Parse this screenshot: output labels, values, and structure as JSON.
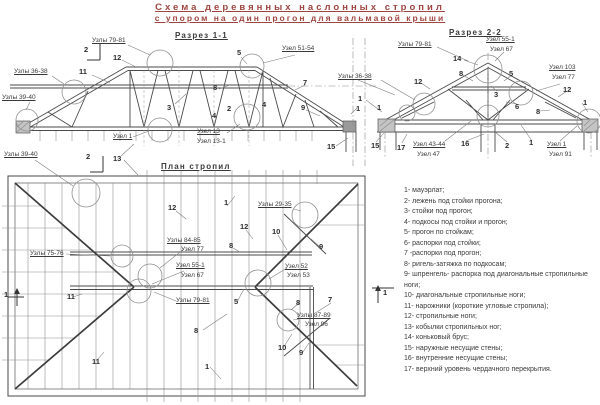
{
  "colors": {
    "title": "#a04540",
    "line": "#4a4a4a",
    "circle": "#909090"
  },
  "title": {
    "line1": "Схема деревянных наслонных стропил",
    "line2": "с упором на один прогон для вальмавой крыши"
  },
  "section1": {
    "title": "Разрез 1-1",
    "labels": [
      {
        "text": "Узлы 79-81",
        "x": 92,
        "y": 37,
        "u": 1
      },
      {
        "text": "2",
        "x": 84,
        "y": 46,
        "b": 1
      },
      {
        "text": "12",
        "x": 113,
        "y": 54,
        "b": 1
      },
      {
        "text": "11",
        "x": 79,
        "y": 68,
        "b": 1
      },
      {
        "text": "Узлы 36-38",
        "x": 14,
        "y": 68,
        "u": 1
      },
      {
        "text": "Узлы 39-40",
        "x": 2,
        "y": 94,
        "u": 1
      },
      {
        "text": "5",
        "x": 237,
        "y": 49,
        "b": 1
      },
      {
        "text": "Узел 51-54",
        "x": 282,
        "y": 45,
        "u": 1
      },
      {
        "text": "8",
        "x": 213,
        "y": 84,
        "b": 1
      },
      {
        "text": "3",
        "x": 167,
        "y": 104,
        "b": 1
      },
      {
        "text": "7",
        "x": 303,
        "y": 79,
        "b": 1
      },
      {
        "text": "2",
        "x": 227,
        "y": 105,
        "b": 1
      },
      {
        "text": "4",
        "x": 212,
        "y": 112,
        "b": 1
      },
      {
        "text": "4",
        "x": 262,
        "y": 101,
        "b": 1
      },
      {
        "text": "9",
        "x": 301,
        "y": 104,
        "b": 1
      },
      {
        "text": "1",
        "x": 356,
        "y": 105,
        "b": 1
      },
      {
        "text": "Узел 13",
        "x": 197,
        "y": 128,
        "u": 1
      },
      {
        "text": "Узел 13-1",
        "x": 197,
        "y": 138
      },
      {
        "text": "Узел 1",
        "x": 113,
        "y": 133,
        "u": 1
      },
      {
        "text": "15",
        "x": 327,
        "y": 143,
        "b": 1
      },
      {
        "text": "2",
        "x": 86,
        "y": 153,
        "b": 1
      }
    ]
  },
  "section2": {
    "title": "Разрез 2-2",
    "labels": [
      {
        "text": "Узлы 79-81",
        "x": 398,
        "y": 41,
        "u": 1
      },
      {
        "text": "14",
        "x": 453,
        "y": 55,
        "b": 1
      },
      {
        "text": "Узел 55-1",
        "x": 486,
        "y": 36,
        "u": 1
      },
      {
        "text": "Узел 67",
        "x": 490,
        "y": 46
      },
      {
        "text": "Узел 103",
        "x": 549,
        "y": 64,
        "u": 1
      },
      {
        "text": "Узел 77",
        "x": 552,
        "y": 74
      },
      {
        "text": "Узлы 36-38",
        "x": 338,
        "y": 73,
        "u": 1
      },
      {
        "text": "8",
        "x": 459,
        "y": 70,
        "b": 1
      },
      {
        "text": "5",
        "x": 509,
        "y": 70,
        "b": 1
      },
      {
        "text": "3",
        "x": 494,
        "y": 91,
        "b": 1
      },
      {
        "text": "12",
        "x": 414,
        "y": 78,
        "b": 1
      },
      {
        "text": "12",
        "x": 563,
        "y": 86,
        "b": 1
      },
      {
        "text": "6",
        "x": 515,
        "y": 103,
        "b": 1
      },
      {
        "text": "8",
        "x": 536,
        "y": 108,
        "b": 1
      },
      {
        "text": "1",
        "x": 358,
        "y": 95,
        "b": 1
      },
      {
        "text": "1",
        "x": 377,
        "y": 104,
        "b": 1
      },
      {
        "text": "1",
        "x": 583,
        "y": 99,
        "b": 1
      },
      {
        "text": "15",
        "x": 371,
        "y": 142,
        "b": 1
      },
      {
        "text": "17",
        "x": 397,
        "y": 144,
        "b": 1
      },
      {
        "text": "Узел 43-44",
        "x": 413,
        "y": 141,
        "u": 1
      },
      {
        "text": "Узел 47",
        "x": 417,
        "y": 151
      },
      {
        "text": "16",
        "x": 461,
        "y": 140,
        "b": 1
      },
      {
        "text": "2",
        "x": 505,
        "y": 142,
        "b": 1
      },
      {
        "text": "1",
        "x": 529,
        "y": 139,
        "b": 1
      },
      {
        "text": "Узел 1",
        "x": 547,
        "y": 141,
        "u": 1
      },
      {
        "text": "Узел 91",
        "x": 549,
        "y": 151
      }
    ]
  },
  "plan": {
    "title": "План стропил",
    "labels": [
      {
        "text": "Узлы 39-40",
        "x": 4,
        "y": 151,
        "u": 1
      },
      {
        "text": "13",
        "x": 113,
        "y": 155,
        "b": 1
      },
      {
        "text": "12",
        "x": 168,
        "y": 204,
        "b": 1
      },
      {
        "text": "1",
        "x": 224,
        "y": 199,
        "b": 1
      },
      {
        "text": "Узлы 29-35",
        "x": 258,
        "y": 201,
        "u": 1
      },
      {
        "text": "12",
        "x": 240,
        "y": 223,
        "b": 1
      },
      {
        "text": "10",
        "x": 272,
        "y": 228,
        "b": 1
      },
      {
        "text": "9",
        "x": 319,
        "y": 243,
        "b": 1
      },
      {
        "text": "Узлы 84-85",
        "x": 167,
        "y": 237,
        "u": 1
      },
      {
        "text": "Узел 77",
        "x": 181,
        "y": 246
      },
      {
        "text": "8",
        "x": 229,
        "y": 242,
        "b": 1
      },
      {
        "text": "Узел 55-1",
        "x": 176,
        "y": 262,
        "u": 1
      },
      {
        "text": "Узел 67",
        "x": 181,
        "y": 272
      },
      {
        "text": "Узлы 75-76",
        "x": 30,
        "y": 250,
        "u": 1
      },
      {
        "text": "Узлы 79-81",
        "x": 176,
        "y": 297,
        "u": 1
      },
      {
        "text": "5",
        "x": 234,
        "y": 298,
        "b": 1
      },
      {
        "text": "Узел 52",
        "x": 285,
        "y": 263,
        "u": 1
      },
      {
        "text": "Узел 53",
        "x": 287,
        "y": 272
      },
      {
        "text": "7",
        "x": 328,
        "y": 296,
        "b": 1
      },
      {
        "text": "8",
        "x": 296,
        "y": 299,
        "b": 1
      },
      {
        "text": "Узлы 87-89",
        "x": 297,
        "y": 312,
        "u": 1
      },
      {
        "text": "Узел 96",
        "x": 305,
        "y": 321
      },
      {
        "text": "8",
        "x": 194,
        "y": 327,
        "b": 1
      },
      {
        "text": "10",
        "x": 278,
        "y": 344,
        "b": 1
      },
      {
        "text": "9",
        "x": 299,
        "y": 349,
        "b": 1
      },
      {
        "text": "11",
        "x": 67,
        "y": 293,
        "b": 1
      },
      {
        "text": "11",
        "x": 92,
        "y": 358,
        "b": 1
      },
      {
        "text": "1",
        "x": 205,
        "y": 363,
        "b": 1
      },
      {
        "text": "1",
        "x": 4,
        "y": 291,
        "b": 1
      },
      {
        "text": "1",
        "x": 383,
        "y": 289,
        "b": 1
      }
    ]
  },
  "legend": {
    "items": [
      "1- мауэрлат;",
      "2- лежень под стойки прогона;",
      "3- стойки под прогон;",
      "4- подкосы под стойки и прогон;",
      "5- прогон по стойкам;",
      "6- распорки под стойки;",
      "7 -распорки под прогон;",
      "8- ригель-затяжка по подкосам;",
      "9- шпренгель- распорка под диагональные стропильные ноги;",
      "10- диагональные стропильные ноги;",
      "11- нарожники (короткие угловые стропила);",
      "12- стропильные ноги;",
      "13- кобылки стропильных ног;",
      "14- коньковый брус;",
      "15- наружные несущие стены;",
      "16- внутренние несущие стены;",
      "17- верхний уровень чердачного перекрытия."
    ]
  }
}
